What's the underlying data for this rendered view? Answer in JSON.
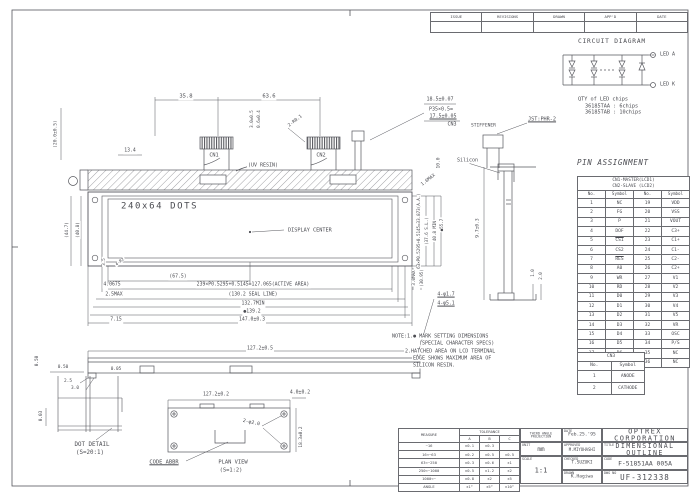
{
  "sheet": {
    "bg": "#ffffff",
    "line_color": "#55565c",
    "text_color": "#4b4c52"
  },
  "revision_table": {
    "headers": [
      "ISSUE",
      "REVISIONS",
      "DRAWN",
      "APP'D",
      "DATE"
    ]
  },
  "circuit": {
    "title": "CIRCUIT DIAGRAM"
  },
  "pin_assignment": {
    "title": "PIN ASSIGNMENT",
    "header_line1": "CN1-MASTER(LCD1)",
    "header_line2": "CN2-SLAVE (LCD2)",
    "col_headers": [
      "No.",
      "Symbol",
      "No.",
      "Symbol"
    ],
    "overline_pins": [
      5,
      7
    ],
    "rows": [
      [
        "1",
        "NC",
        "19",
        "VDD"
      ],
      [
        "2",
        "FG",
        "20",
        "VSS"
      ],
      [
        "3",
        "P",
        "21",
        "VOUT"
      ],
      [
        "4",
        "DOF",
        "22",
        "C3+"
      ],
      [
        "5",
        "CS1",
        "23",
        "C1+"
      ],
      [
        "6",
        "CS2",
        "24",
        "C1-"
      ],
      [
        "7",
        "RES",
        "25",
        "C2-"
      ],
      [
        "8",
        "A0",
        "26",
        "C2+"
      ],
      [
        "9",
        "WR",
        "27",
        "V1"
      ],
      [
        "10",
        "RD",
        "28",
        "V2"
      ],
      [
        "11",
        "D0",
        "29",
        "V3"
      ],
      [
        "12",
        "D1",
        "30",
        "V4"
      ],
      [
        "13",
        "D2",
        "31",
        "V5"
      ],
      [
        "14",
        "D3",
        "32",
        "VR"
      ],
      [
        "15",
        "D4",
        "33",
        "OSC"
      ],
      [
        "16",
        "D5",
        "34",
        "P/S"
      ],
      [
        "17",
        "D6",
        "35",
        "NC"
      ],
      [
        "18",
        "D7",
        "36",
        "NC"
      ]
    ],
    "cn3": {
      "title": "CN3",
      "col_headers": [
        "No.",
        "Symbol"
      ],
      "rows": [
        [
          "1",
          "ANODE"
        ],
        [
          "2",
          "CATHODE"
        ]
      ]
    }
  },
  "tolerance_table": {
    "measure_label": "MEASURE",
    "tolerance_label": "TOLERANCE",
    "col_headers": [
      "A",
      "B",
      "C"
    ],
    "rows": [
      [
        "~16",
        "±0.1",
        "±0.3",
        ""
      ],
      [
        "16<~63",
        "±0.2",
        "±0.5",
        "±0.5"
      ],
      [
        "63<~250",
        "±0.3",
        "±0.6",
        "±1"
      ],
      [
        "250<~1000",
        "±0.5",
        "±1.2",
        "±2"
      ],
      [
        "1000<~",
        "±0.8",
        "±2",
        "±5"
      ],
      [
        "ANGLE",
        "±1°",
        "±5°",
        "±10°"
      ]
    ]
  },
  "title_block": {
    "projection": "THIRD ANGLE PROJECTION",
    "date_label": "DATE",
    "date": "Feb.25.'95",
    "unit_label": "UNIT",
    "unit": "mm",
    "scale_label": "SCALE",
    "scale": "1:1",
    "approved_label": "APPROVED",
    "approved": "M.MIYOHASHI",
    "checked_label": "CHECKED",
    "checked": "T.SUZUKI",
    "drawn_label": "DRAWN",
    "drawn": "K.Hagiwa",
    "company": "OPTREX CORPORATION",
    "title_label": "TITLE",
    "drawing_title": "DIMENSIONAL OUTLINE",
    "code_label": "CODE",
    "code": "F-51851AA 005A",
    "dwg_label": "DWG NO",
    "dwg_no": "UF-312338"
  },
  "annotations": [
    {
      "t": "CIRCUIT DIAGRAM",
      "x": 577,
      "y": 42,
      "a": "l",
      "fs": 6.2,
      "ls": 0.8
    },
    {
      "t": "LED A",
      "x": 659,
      "y": 55,
      "a": "l",
      "fs": 5
    },
    {
      "t": "LED K",
      "x": 659,
      "y": 85,
      "a": "l",
      "fs": 5
    },
    {
      "t": "QTY of LED chips",
      "x": 577,
      "y": 100,
      "a": "l",
      "fs": 5.2
    },
    {
      "t": "36185TAA : 6chips",
      "x": 584,
      "y": 107,
      "a": "l",
      "fs": 5.2
    },
    {
      "t": "36185TAB : 10chips",
      "x": 584,
      "y": 113,
      "a": "l",
      "fs": 5.2
    },
    {
      "t": "JST:PHR-2",
      "x": 542,
      "y": 120,
      "fs": 5.2,
      "u": 1
    },
    {
      "t": "STIFFENER",
      "x": 470,
      "y": 127,
      "a": "l",
      "fs": 4.6
    },
    {
      "t": "35.8",
      "x": 186,
      "y": 97
    },
    {
      "t": "63.6",
      "x": 269,
      "y": 97
    },
    {
      "t": "18.5±0.07",
      "x": 440,
      "y": 100,
      "fs": 5
    },
    {
      "t": "P35×0.5=",
      "x": 441,
      "y": 110,
      "fs": 5
    },
    {
      "t": "17.5±0.05",
      "x": 443,
      "y": 117,
      "fs": 5,
      "u": 1
    },
    {
      "t": "CN3",
      "x": 452,
      "y": 125,
      "fs": 5
    },
    {
      "t": "CN1",
      "x": 214,
      "y": 156,
      "fs": 5.2
    },
    {
      "t": "CN2",
      "x": 321,
      "y": 156,
      "fs": 5.2
    },
    {
      "t": "(UV RESIN)",
      "x": 263,
      "y": 166,
      "fs": 5
    },
    {
      "t": "2-R0.1",
      "x": 296,
      "y": 122,
      "r": -38,
      "fs": 4.6
    },
    {
      "t": "3.0±0.5",
      "x": 252,
      "y": 119,
      "r": -90,
      "fs": 4.2
    },
    {
      "t": "0.6±0.4",
      "x": 259,
      "y": 119,
      "r": -90,
      "fs": 4.2
    },
    {
      "t": "13.4",
      "x": 130,
      "y": 152,
      "fs": 4.8
    },
    {
      "t": "(20.0±0.5)",
      "x": 57,
      "y": 134,
      "r": -90,
      "fs": 4.6
    },
    {
      "t": "Silicon",
      "x": 456,
      "y": 161,
      "a": "l",
      "fs": 5
    },
    {
      "t": "10.0",
      "x": 440,
      "y": 163,
      "r": -90,
      "fs": 4.6
    },
    {
      "t": "1.6MAX",
      "x": 429,
      "y": 181,
      "r": -38,
      "fs": 4.6
    },
    {
      "t": "240x64 DOTS",
      "x": 120,
      "y": 207,
      "a": "l",
      "fs": 9,
      "ls": 1.6
    },
    {
      "t": "DISPLAY CENTER",
      "x": 287,
      "y": 231,
      "a": "l",
      "fs": 5.2
    },
    {
      "t": "(67.5)",
      "x": 178,
      "y": 278,
      "fs": 4.8
    },
    {
      "t": "4.0675",
      "x": 112,
      "y": 286,
      "fs": 4.8
    },
    {
      "t": "239×P0.5295+0.5145=127.065(ACTIVE AREA)",
      "x": 253,
      "y": 286,
      "fs": 4.8
    },
    {
      "t": "2.5MAX",
      "x": 114,
      "y": 296,
      "fs": 4.8
    },
    {
      "t": "(130.2 SEAL LINE)",
      "x": 253,
      "y": 296,
      "fs": 4.8
    },
    {
      "t": "132.7MIN",
      "x": 253,
      "y": 305,
      "fs": 4.8
    },
    {
      "t": "●139.2",
      "x": 252,
      "y": 313,
      "fs": 4.8
    },
    {
      "t": "7.15",
      "x": 116,
      "y": 321,
      "fs": 4.8
    },
    {
      "t": "147.0±0.3",
      "x": 252,
      "y": 321,
      "fs": 4.8
    },
    {
      "t": "3.5",
      "x": 104,
      "y": 262,
      "r": -90,
      "fs": 4.2
    },
    {
      "t": "4-R2",
      "x": 120,
      "y": 262,
      "r": -38,
      "fs": 4.2
    },
    {
      "t": "(44.7)",
      "x": 68,
      "y": 230,
      "r": -90,
      "fs": 4.4
    },
    {
      "t": "(40.8)",
      "x": 79,
      "y": 230,
      "r": -90,
      "fs": 4.4
    },
    {
      "t": "63×P0.5295+0.5145=33.873(A.A.)",
      "x": 419,
      "y": 231,
      "r": -90,
      "fs": 4.2
    },
    {
      "t": "(37.6 S.L.)",
      "x": 427,
      "y": 231,
      "r": -90,
      "fs": 4.2
    },
    {
      "t": "40.8 MIN",
      "x": 435,
      "y": 231,
      "r": -90,
      "fs": 4.2
    },
    {
      "t": "●55.7",
      "x": 442,
      "y": 225,
      "r": -90,
      "fs": 4.2
    },
    {
      "t": "3.0MAX",
      "x": 414,
      "y": 278,
      "r": -90,
      "fs": 4.2
    },
    {
      "t": "(30.95)",
      "x": 422,
      "y": 278,
      "r": -90,
      "fs": 4.2
    },
    {
      "t": "9.7±0.3",
      "x": 479,
      "y": 228,
      "r": -90,
      "fs": 4.6
    },
    {
      "t": "1.0",
      "x": 533,
      "y": 273,
      "r": -90,
      "fs": 4.2
    },
    {
      "t": "2.0",
      "x": 541,
      "y": 276,
      "r": -90,
      "fs": 4.2
    },
    {
      "t": "4-φ1.7",
      "x": 446,
      "y": 296,
      "fs": 4.8,
      "u": 1
    },
    {
      "t": "4-φ5.1",
      "x": 446,
      "y": 305,
      "fs": 4.8,
      "u": 1
    },
    {
      "t": "127.2±0.5",
      "x": 260,
      "y": 350,
      "fs": 4.8
    },
    {
      "t": "2.5",
      "x": 68,
      "y": 382,
      "fs": 4.4
    },
    {
      "t": "3.0",
      "x": 75,
      "y": 389,
      "fs": 4.4
    },
    {
      "t": "0.50",
      "x": 63,
      "y": 368,
      "fs": 4.4
    },
    {
      "t": "0.05",
      "x": 116,
      "y": 370,
      "fs": 4.4
    },
    {
      "t": "0.50",
      "x": 38,
      "y": 361,
      "r": -90,
      "fs": 4.4
    },
    {
      "t": "0.03",
      "x": 42,
      "y": 416,
      "r": -90,
      "fs": 4.4
    },
    {
      "t": "DOT DETAIL",
      "x": 92,
      "y": 446,
      "fs": 5.8
    },
    {
      "t": "(S=20:1)",
      "x": 90,
      "y": 454,
      "fs": 5.8
    },
    {
      "t": "127.2±0.2",
      "x": 216,
      "y": 396,
      "fs": 4.8
    },
    {
      "t": "4.0±0.2",
      "x": 300,
      "y": 394,
      "fs": 4.8
    },
    {
      "t": "2-φ2.0",
      "x": 251,
      "y": 424,
      "r": 12,
      "fs": 4.8
    },
    {
      "t": "18.3±0.2",
      "x": 302,
      "y": 437,
      "r": -90,
      "fs": 4.4
    },
    {
      "t": "PLAN VIEW",
      "x": 233,
      "y": 463,
      "fs": 5.4
    },
    {
      "t": "(S=1:2)",
      "x": 231,
      "y": 471,
      "fs": 5.4
    },
    {
      "t": "CODE ABBR",
      "x": 164,
      "y": 463,
      "fs": 5.4,
      "u": 1
    },
    {
      "t": "NOTE:1.● MARK SETTING DIMENSIONS",
      "x": 391,
      "y": 337,
      "a": "l",
      "fs": 5
    },
    {
      "t": "(SPECIAL CHARACTER SPECS)",
      "x": 418,
      "y": 344,
      "a": "l",
      "fs": 5
    },
    {
      "t": "2.HATCHED AREA ON LCD TERMINAL",
      "x": 404,
      "y": 352,
      "a": "l",
      "fs": 5
    },
    {
      "t": "EDGE SHOWS MAXIMUM AREA OF",
      "x": 412,
      "y": 359,
      "a": "l",
      "fs": 5
    },
    {
      "t": "SILICON RESIN.",
      "x": 412,
      "y": 366,
      "a": "l",
      "fs": 5
    }
  ]
}
